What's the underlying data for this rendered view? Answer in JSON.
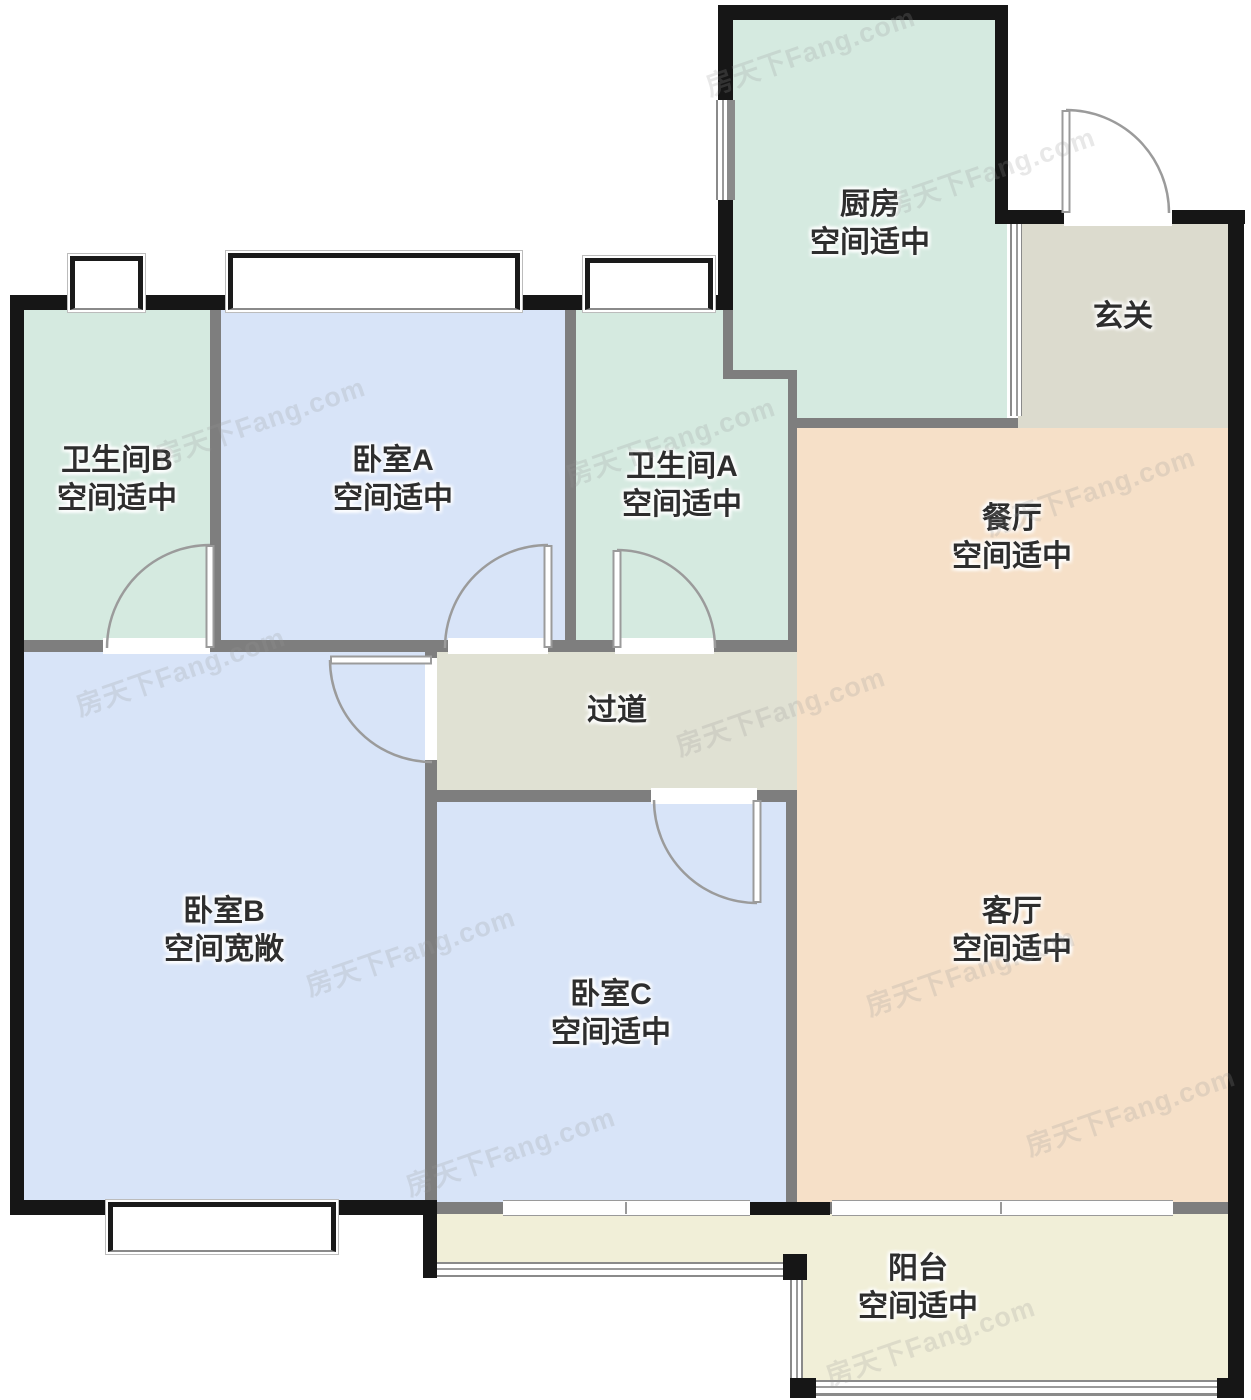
{
  "watermark": "房天下Fang.com",
  "rooms": {
    "kitchen": {
      "name": "厨房",
      "note": "空间适中"
    },
    "entry": {
      "name": "玄关",
      "note": ""
    },
    "bath_b": {
      "name": "卫生间B",
      "note": "空间适中"
    },
    "bed_a": {
      "name": "卧室A",
      "note": "空间适中"
    },
    "bath_a": {
      "name": "卫生间A",
      "note": "空间适中"
    },
    "dining": {
      "name": "餐厅",
      "note": "空间适中"
    },
    "hallway": {
      "name": "过道",
      "note": ""
    },
    "bed_b": {
      "name": "卧室B",
      "note": "空间宽敞"
    },
    "bed_c": {
      "name": "卧室C",
      "note": "空间适中"
    },
    "living": {
      "name": "客厅",
      "note": "空间适中"
    },
    "balcony": {
      "name": "阳台",
      "note": "空间适中"
    }
  },
  "colors": {
    "wet_rooms": "#d5eae0",
    "bedrooms": "#d8e4f8",
    "living_dining": "#f6e0c8",
    "entry_hall": "#dcdbce",
    "corridor": "#e0e1d3",
    "balcony": "#f1efd8",
    "outer_wall": "#161616",
    "partition_wall": "#7e7e7e"
  }
}
